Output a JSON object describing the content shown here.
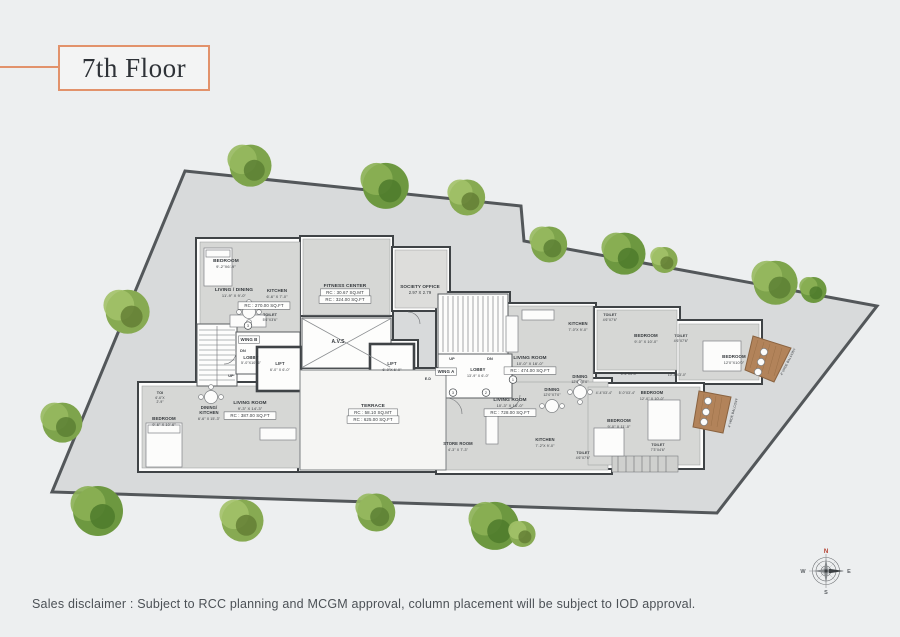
{
  "title": {
    "label": "7th Floor"
  },
  "disclaimer": "Sales disclaimer : Subject to RCC planning and MCGM approval, column placement will be subject to IOD approval.",
  "compass": {
    "n": "N",
    "e": "E",
    "s": "S",
    "w": "W"
  },
  "plan": {
    "labels": [
      {
        "t": "BEDROOM",
        "x": 226,
        "y": 262,
        "s": 4.8,
        "b": 1
      },
      {
        "t": "9'-2\"X6'-9\"",
        "x": 226,
        "y": 268,
        "s": 4
      },
      {
        "t": "LIVING / DINING",
        "x": 234,
        "y": 291,
        "s": 4.8,
        "b": 1
      },
      {
        "t": "11'-9\" X 9'-0\"",
        "x": 234,
        "y": 297,
        "s": 4
      },
      {
        "t": "RC : 270.00 SQ.FT",
        "x": 264,
        "y": 307,
        "s": 4.4,
        "box": 1
      },
      {
        "t": "KITCHEN",
        "x": 277,
        "y": 292,
        "s": 4.4,
        "b": 1
      },
      {
        "t": "6'-6\" X 7'-0\"",
        "x": 277,
        "y": 298,
        "s": 3.8
      },
      {
        "t": "TOILET",
        "x": 270,
        "y": 316,
        "s": 3.8,
        "b": 1
      },
      {
        "t": "5'6\"X3'6\"",
        "x": 270,
        "y": 321,
        "s": 3.5
      },
      {
        "t": "WING B",
        "x": 249,
        "y": 341,
        "s": 4.4,
        "b": 1,
        "box": 1
      },
      {
        "t": "DN",
        "x": 243,
        "y": 352,
        "s": 3.8,
        "b": 1
      },
      {
        "t": "LOBBY",
        "x": 251,
        "y": 359,
        "s": 4.2,
        "b": 1
      },
      {
        "t": "5'-0\"X10'-6\"",
        "x": 251,
        "y": 364,
        "s": 3.6
      },
      {
        "t": "UP",
        "x": 231,
        "y": 377,
        "s": 3.8,
        "b": 1
      },
      {
        "t": "LIFT",
        "x": 280,
        "y": 365,
        "s": 4.2,
        "b": 1
      },
      {
        "t": "6'-0\" X 6'-0\"",
        "x": 280,
        "y": 371,
        "s": 3.6
      },
      {
        "t": "FITNESS CENTER",
        "x": 345,
        "y": 287,
        "s": 4.8,
        "b": 1
      },
      {
        "t": "RC : 30.67 SQ.MT",
        "x": 345,
        "y": 294,
        "s": 4.4,
        "box": 1
      },
      {
        "t": "RC : 324.00 SQ.FT",
        "x": 345,
        "y": 301,
        "s": 4.4,
        "box": 1
      },
      {
        "t": "SOCIETY OFFICE",
        "x": 420,
        "y": 288,
        "s": 4.6,
        "b": 1
      },
      {
        "t": "2.97 X 2.79",
        "x": 420,
        "y": 294,
        "s": 4.2
      },
      {
        "t": "A.V.S",
        "x": 338,
        "y": 343,
        "s": 5,
        "b": 1
      },
      {
        "t": "LIFT",
        "x": 392,
        "y": 365,
        "s": 4.2,
        "b": 1
      },
      {
        "t": "6'-0\"X 6'-0\"",
        "x": 392,
        "y": 371,
        "s": 3.6
      },
      {
        "t": "WING A",
        "x": 446,
        "y": 373,
        "s": 4.4,
        "b": 1,
        "box": 1
      },
      {
        "t": "LOBBY",
        "x": 478,
        "y": 371,
        "s": 4.2,
        "b": 1
      },
      {
        "t": "13'-9\" X 6'-0\"",
        "x": 478,
        "y": 377,
        "s": 3.6
      },
      {
        "t": "UP",
        "x": 452,
        "y": 360,
        "s": 3.8,
        "b": 1
      },
      {
        "t": "DN",
        "x": 490,
        "y": 360,
        "s": 3.8,
        "b": 1
      },
      {
        "t": "E.D",
        "x": 428,
        "y": 380,
        "s": 3.5,
        "b": 1
      },
      {
        "t": "LIVING ROOM",
        "x": 530,
        "y": 359,
        "s": 4.8,
        "b": 1
      },
      {
        "t": "10'-0\" X 16'-0\"",
        "x": 530,
        "y": 365,
        "s": 4
      },
      {
        "t": "RC : 474.00 SQ.FT",
        "x": 530,
        "y": 372,
        "s": 4.4,
        "box": 1
      },
      {
        "t": "KITCHEN",
        "x": 578,
        "y": 325,
        "s": 4.2,
        "b": 1
      },
      {
        "t": "7'-0\"X 9'-0\"",
        "x": 578,
        "y": 331,
        "s": 3.6
      },
      {
        "t": "TOILET",
        "x": 610,
        "y": 316,
        "s": 3.6,
        "b": 1
      },
      {
        "t": "4'6\"X7'6\"",
        "x": 610,
        "y": 321,
        "s": 3.4
      },
      {
        "t": "BEDROOM",
        "x": 646,
        "y": 337,
        "s": 4.4,
        "b": 1
      },
      {
        "t": "9'-0\" X 10'-0\"",
        "x": 646,
        "y": 343,
        "s": 3.8
      },
      {
        "t": "TOILET",
        "x": 681,
        "y": 337,
        "s": 3.6,
        "b": 1
      },
      {
        "t": "4'6\"X7'6\"",
        "x": 681,
        "y": 342,
        "s": 3.4
      },
      {
        "t": "BEDROOM",
        "x": 734,
        "y": 358,
        "s": 4.4,
        "b": 1
      },
      {
        "t": "12'0\"X10'0\"",
        "x": 734,
        "y": 364,
        "s": 3.8
      },
      {
        "t": "DINING",
        "x": 580,
        "y": 378,
        "s": 4.2,
        "b": 1
      },
      {
        "t": "12'0\"X7'0\"",
        "x": 580,
        "y": 383,
        "s": 3.6
      },
      {
        "t": "4' WIDE BALCONY",
        "x": 789,
        "y": 362,
        "s": 3.3,
        "r": -63
      },
      {
        "t": "5'-4\"X3'-0\"",
        "x": 629,
        "y": 375,
        "s": 3.3
      },
      {
        "t": "10'-4\"X3'-0\"",
        "x": 677,
        "y": 376,
        "s": 3.3
      },
      {
        "t": "4'-4\"X3'-4\"",
        "x": 604,
        "y": 394,
        "s": 3.3
      },
      {
        "t": "5'-0\"X3'-4\"",
        "x": 627,
        "y": 394,
        "s": 3.3
      },
      {
        "t": "BEDROOM",
        "x": 652,
        "y": 394,
        "s": 4.2,
        "b": 1
      },
      {
        "t": "12'-0\" X 10'-0\"",
        "x": 652,
        "y": 400,
        "s": 3.6
      },
      {
        "t": "DINING",
        "x": 552,
        "y": 391,
        "s": 4.2,
        "b": 1
      },
      {
        "t": "12'0\"X7'0\"",
        "x": 552,
        "y": 396,
        "s": 3.6
      },
      {
        "t": "LIVING ROOM",
        "x": 510,
        "y": 401,
        "s": 4.8,
        "b": 1
      },
      {
        "t": "10'-3\" X 16'-0\"",
        "x": 510,
        "y": 407,
        "s": 4
      },
      {
        "t": "RC : 728.00 SQ.FT",
        "x": 510,
        "y": 414,
        "s": 4.4,
        "box": 1
      },
      {
        "t": "BEDROOM",
        "x": 619,
        "y": 422,
        "s": 4.4,
        "b": 1
      },
      {
        "t": "9'-0\" X 11'-0\"",
        "x": 619,
        "y": 428,
        "s": 3.8
      },
      {
        "t": "KITCHEN",
        "x": 545,
        "y": 441,
        "s": 4.2,
        "b": 1
      },
      {
        "t": "7'-2\"X 9'-0\"",
        "x": 545,
        "y": 447,
        "s": 3.6
      },
      {
        "t": "TOILET",
        "x": 583,
        "y": 454,
        "s": 3.6,
        "b": 1
      },
      {
        "t": "4'6\"X7'6\"",
        "x": 583,
        "y": 459,
        "s": 3.4
      },
      {
        "t": "TOILET",
        "x": 658,
        "y": 446,
        "s": 3.6,
        "b": 1
      },
      {
        "t": "7'3\"X4'6\"",
        "x": 658,
        "y": 451,
        "s": 3.4
      },
      {
        "t": "STORE ROOM",
        "x": 458,
        "y": 445,
        "s": 4.2,
        "b": 1
      },
      {
        "t": "4'-3\" X 7'-3\"",
        "x": 458,
        "y": 451,
        "s": 3.6
      },
      {
        "t": "4' WIDE BALCONY",
        "x": 734,
        "y": 413,
        "s": 3.3,
        "r": -75
      },
      {
        "t": "TERRACE",
        "x": 373,
        "y": 407,
        "s": 4.8,
        "b": 1
      },
      {
        "t": "RC : 58.10 SQ.MT",
        "x": 373,
        "y": 414,
        "s": 4.4,
        "box": 1
      },
      {
        "t": "RC : 625.00 SQ.FT",
        "x": 373,
        "y": 421,
        "s": 4.4,
        "box": 1
      },
      {
        "t": "TOI",
        "x": 160,
        "y": 394,
        "s": 3.8,
        "b": 1
      },
      {
        "t": "6'-6\"X",
        "x": 160,
        "y": 399,
        "s": 3.3
      },
      {
        "t": "2'-9\"",
        "x": 160,
        "y": 403,
        "s": 3.3
      },
      {
        "t": "BEDROOM",
        "x": 164,
        "y": 420,
        "s": 4.4,
        "b": 1
      },
      {
        "t": "9'-6\" X 10'-6\"",
        "x": 164,
        "y": 426,
        "s": 3.8
      },
      {
        "t": "DINING/",
        "x": 209,
        "y": 409,
        "s": 4.2,
        "b": 1
      },
      {
        "t": "KITCHEN",
        "x": 209,
        "y": 414,
        "s": 4.2,
        "b": 1
      },
      {
        "t": "6'-6\" X 15'-3\"",
        "x": 209,
        "y": 420,
        "s": 3.6
      },
      {
        "t": "LIVING ROOM",
        "x": 250,
        "y": 404,
        "s": 4.8,
        "b": 1
      },
      {
        "t": "9'-3\" X 14'-3\"",
        "x": 250,
        "y": 410,
        "s": 4
      },
      {
        "t": "RC : 387.00 SQ.FT",
        "x": 250,
        "y": 417,
        "s": 4.4,
        "box": 1
      },
      {
        "t": "3",
        "x": 248,
        "y": 327,
        "s": 3.8,
        "c": 1
      },
      {
        "t": "3",
        "x": 453,
        "y": 394,
        "s": 3.8,
        "c": 1
      },
      {
        "t": "2",
        "x": 486,
        "y": 394,
        "s": 3.8,
        "c": 1
      },
      {
        "t": "1",
        "x": 513,
        "y": 381,
        "s": 3.8,
        "c": 1
      }
    ],
    "trees": [
      {
        "x": 248,
        "y": 164,
        "r": 21
      },
      {
        "x": 383,
        "y": 184,
        "r": 23
      },
      {
        "x": 465,
        "y": 196,
        "r": 18
      },
      {
        "x": 547,
        "y": 243,
        "r": 18
      },
      {
        "x": 622,
        "y": 252,
        "r": 21
      },
      {
        "x": 663,
        "y": 259,
        "r": 13
      },
      {
        "x": 773,
        "y": 281,
        "r": 22
      },
      {
        "x": 812,
        "y": 289,
        "r": 13
      },
      {
        "x": 125,
        "y": 310,
        "r": 22
      },
      {
        "x": 60,
        "y": 421,
        "r": 20
      },
      {
        "x": 95,
        "y": 509,
        "r": 25
      },
      {
        "x": 240,
        "y": 519,
        "r": 21
      },
      {
        "x": 374,
        "y": 511,
        "r": 19
      },
      {
        "x": 492,
        "y": 524,
        "r": 24
      },
      {
        "x": 521,
        "y": 533,
        "r": 13
      }
    ]
  }
}
